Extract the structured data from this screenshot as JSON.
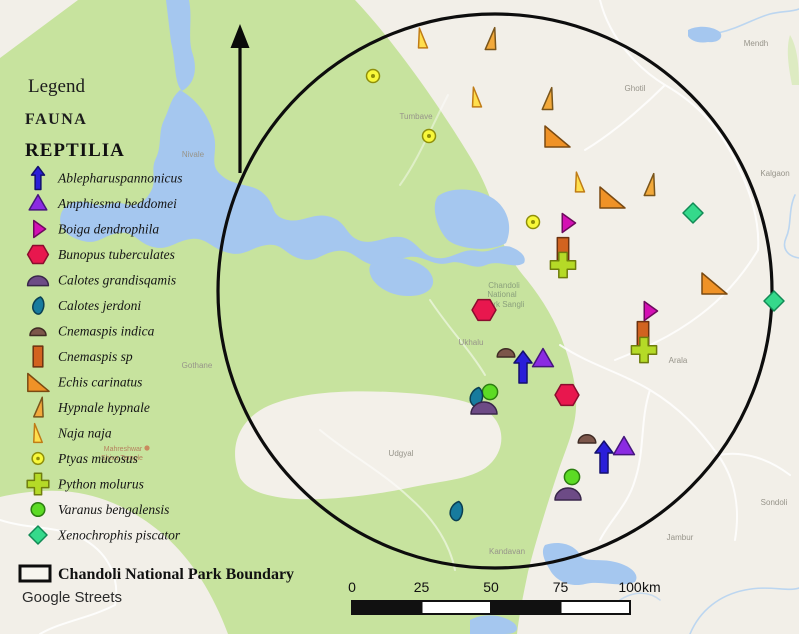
{
  "legend": {
    "title": "Legend",
    "fauna_heading": "FAUNA",
    "group_heading": "REPTILIA"
  },
  "species": [
    {
      "id": "ablepharus",
      "name": "Ablepharuspannonicus",
      "shape": "arrow-up",
      "fill": "#2a1fd9",
      "stroke": "#14106e",
      "ls": 0.72,
      "ms": 1.0
    },
    {
      "id": "amphiesma",
      "name": "Amphiesma beddomei",
      "shape": "triangle",
      "fill": "#8b2be2",
      "stroke": "#45157d",
      "ls": 0.8,
      "ms": 0.95
    },
    {
      "id": "boiga",
      "name": "Boiga dendrophila",
      "shape": "triangle-right",
      "fill": "#d410b4",
      "stroke": "#6e0a5e",
      "ls": 0.85,
      "ms": 0.95
    },
    {
      "id": "bunopus",
      "name": "Bunopus tuberculates",
      "shape": "hexagon",
      "fill": "#e8174e",
      "stroke": "#8a0d2e",
      "ls": 0.8,
      "ms": 0.92
    },
    {
      "id": "calotes-g",
      "name": "Calotes grandisqamis",
      "shape": "dome",
      "fill": "#6d4b86",
      "stroke": "#39264a",
      "ls": 0.8,
      "ms": 1.0
    },
    {
      "id": "calotes-j",
      "name": "Calotes jerdoni",
      "shape": "leaf",
      "fill": "#177b9e",
      "stroke": "#0b3f52",
      "ls": 0.85,
      "ms": 0.95
    },
    {
      "id": "cnemaspis-i",
      "name": "Cnemaspis indica",
      "shape": "dome-small",
      "fill": "#7c564a",
      "stroke": "#3f2b24",
      "ls": 1.0,
      "ms": 1.1
    },
    {
      "id": "cnemaspis-sp",
      "name": "Cnemaspis sp",
      "shape": "rect-v",
      "fill": "#d2631f",
      "stroke": "#6b3210",
      "ls": 0.8,
      "ms": 0.95
    },
    {
      "id": "echis",
      "name": "Echis carinatus",
      "shape": "triangle-rt",
      "fill": "#ef9227",
      "stroke": "#7a4a12",
      "ls": 0.85,
      "ms": 1.0
    },
    {
      "id": "hypnale",
      "name": "Hypnale hypnale",
      "shape": "triangle-slim-r",
      "fill": "#f2a93b",
      "stroke": "#7a551a",
      "ls": 0.85,
      "ms": 0.95
    },
    {
      "id": "naja",
      "name": "Naja naja",
      "shape": "triangle-slim-l",
      "fill": "#ffdf4d",
      "stroke": "#c07c16",
      "ls": 0.85,
      "ms": 0.9
    },
    {
      "id": "ptyas",
      "name": "Ptyas mucosus",
      "shape": "circle-dot",
      "fill": "#f8f83a",
      "stroke": "#8f8f0a",
      "ls": 0.9,
      "ms": 1.0
    },
    {
      "id": "python",
      "name": "Python molurus",
      "shape": "plus",
      "fill": "#b5da27",
      "stroke": "#6f7d0d",
      "ls": 0.9,
      "ms": 1.05
    },
    {
      "id": "varanus",
      "name": "Varanus bengalensis",
      "shape": "circle",
      "fill": "#5cdb24",
      "stroke": "#2c7d10",
      "ls": 0.85,
      "ms": 0.95
    },
    {
      "id": "xenochrophis",
      "name": "Xenochrophis piscator",
      "shape": "diamond",
      "fill": "#35d98b",
      "stroke": "#128a55",
      "ls": 0.9,
      "ms": 1.0
    }
  ],
  "map": {
    "markers": [
      {
        "sp": "naja",
        "x": 423,
        "y": 38
      },
      {
        "sp": "hypnale",
        "x": 490,
        "y": 39
      },
      {
        "sp": "ptyas",
        "x": 373,
        "y": 76
      },
      {
        "sp": "naja",
        "x": 477,
        "y": 97
      },
      {
        "sp": "hypnale",
        "x": 547,
        "y": 99
      },
      {
        "sp": "ptyas",
        "x": 429,
        "y": 136
      },
      {
        "sp": "echis",
        "x": 557,
        "y": 136
      },
      {
        "sp": "naja",
        "x": 580,
        "y": 182
      },
      {
        "sp": "hypnale",
        "x": 649,
        "y": 185
      },
      {
        "sp": "echis",
        "x": 612,
        "y": 197
      },
      {
        "sp": "xenochrophis",
        "x": 693,
        "y": 213
      },
      {
        "sp": "ptyas",
        "x": 533,
        "y": 222
      },
      {
        "sp": "boiga",
        "x": 567,
        "y": 223
      },
      {
        "sp": "cnemaspis-sp",
        "x": 563,
        "y": 250
      },
      {
        "sp": "python",
        "x": 563,
        "y": 265
      },
      {
        "sp": "echis",
        "x": 714,
        "y": 283
      },
      {
        "sp": "xenochrophis",
        "x": 774,
        "y": 301
      },
      {
        "sp": "bunopus",
        "x": 484,
        "y": 310
      },
      {
        "sp": "boiga",
        "x": 649,
        "y": 311
      },
      {
        "sp": "cnemaspis-sp",
        "x": 643,
        "y": 334
      },
      {
        "sp": "python",
        "x": 644,
        "y": 350
      },
      {
        "sp": "cnemaspis-i",
        "x": 506,
        "y": 352
      },
      {
        "sp": "amphiesma",
        "x": 543,
        "y": 359
      },
      {
        "sp": "ablepharus",
        "x": 523,
        "y": 367
      },
      {
        "sp": "varanus",
        "x": 490,
        "y": 392
      },
      {
        "sp": "bunopus",
        "x": 567,
        "y": 395
      },
      {
        "sp": "calotes-j",
        "x": 476,
        "y": 397
      },
      {
        "sp": "calotes-g",
        "x": 484,
        "y": 407
      },
      {
        "sp": "cnemaspis-i",
        "x": 587,
        "y": 438
      },
      {
        "sp": "amphiesma",
        "x": 624,
        "y": 447
      },
      {
        "sp": "ablepharus",
        "x": 604,
        "y": 457
      },
      {
        "sp": "varanus",
        "x": 572,
        "y": 477
      },
      {
        "sp": "calotes-g",
        "x": 568,
        "y": 493
      },
      {
        "sp": "calotes-j",
        "x": 456,
        "y": 511
      }
    ],
    "labels": [
      {
        "t": "Nivale",
        "x": 193,
        "y": 157,
        "c": "town"
      },
      {
        "t": "Tumbave",
        "x": 416,
        "y": 119,
        "c": "town"
      },
      {
        "t": "Ghotil",
        "x": 635,
        "y": 91,
        "c": "town"
      },
      {
        "t": "Mendh",
        "x": 756,
        "y": 46,
        "c": "town"
      },
      {
        "t": "Kalgaon",
        "x": 775,
        "y": 176,
        "c": "town"
      },
      {
        "t": "Gothane",
        "x": 197,
        "y": 368,
        "c": "town"
      },
      {
        "t": "Ukhalu",
        "x": 471,
        "y": 345,
        "c": "town"
      },
      {
        "t": "Udgyal",
        "x": 401,
        "y": 456,
        "c": "town"
      },
      {
        "t": "Arala",
        "x": 678,
        "y": 363,
        "c": "town"
      },
      {
        "t": "Kandavan",
        "x": 507,
        "y": 554,
        "c": "town"
      },
      {
        "t": "Sondoli",
        "x": 774,
        "y": 505,
        "c": "town"
      },
      {
        "t": "Jambur",
        "x": 680,
        "y": 540,
        "c": "town"
      },
      {
        "t": "Chandoli",
        "x": 504,
        "y": 288,
        "c": "park"
      },
      {
        "t": "National",
        "x": 502,
        "y": 297,
        "c": "park"
      },
      {
        "t": "Park Sangli",
        "x": 504,
        "y": 307,
        "c": "park"
      },
      {
        "t": "Mahreshwar",
        "x": 123,
        "y": 451,
        "c": "poi"
      },
      {
        "t": "Shiva Temple",
        "x": 122,
        "y": 460,
        "c": "poi"
      }
    ]
  },
  "footer": {
    "boundary_label": "Chandoli National Park Boundary",
    "basemap_label": "Google Streets"
  },
  "scalebar": {
    "ticks": [
      "0",
      "25",
      "50",
      "75",
      "100"
    ],
    "unit": "km"
  },
  "colors": {
    "land": "#f2efe8",
    "park_green": "#c7e39e",
    "water": "#a5c7ef",
    "clearing": "#f3f0e9",
    "boundary_circle": "#0d0d0d",
    "north_arrow": "#0a0a0a"
  }
}
